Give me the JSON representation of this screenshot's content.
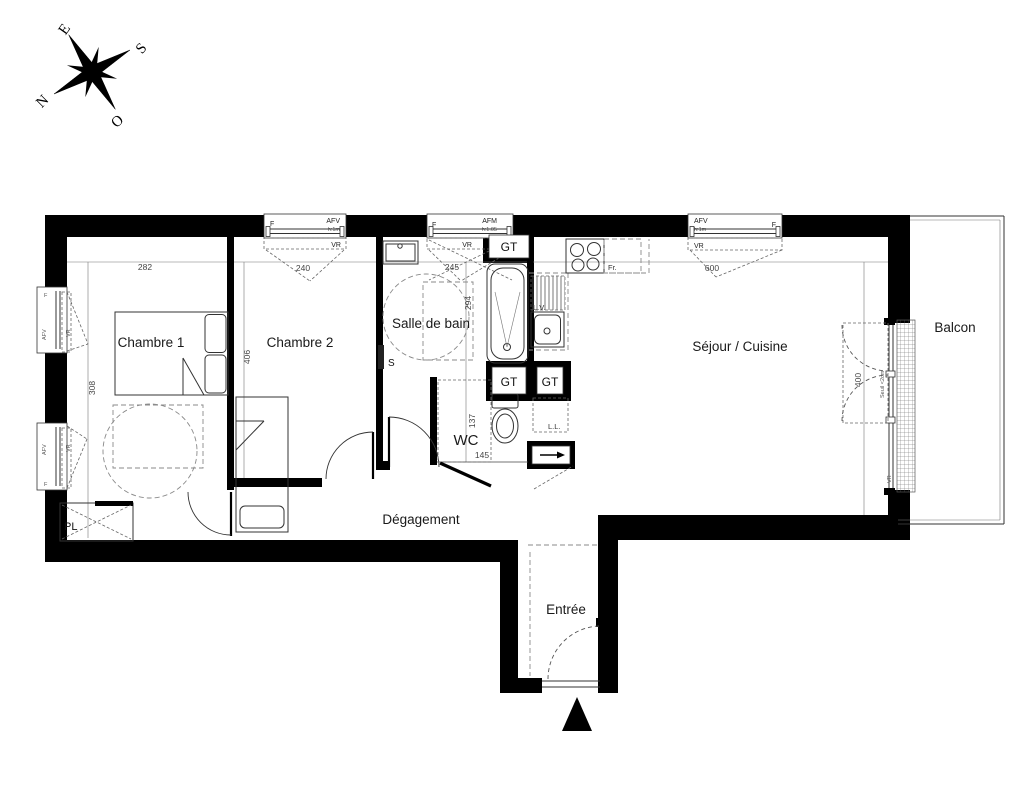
{
  "meta": {
    "type": "floor-plan",
    "style": "french-architectural"
  },
  "colors": {
    "wall": "#000000",
    "line": "#333333",
    "dash": "#8a8a8a",
    "text": "#1a1a1a",
    "dim_text": "#444444",
    "background": "#ffffff"
  },
  "compass": {
    "n": "N",
    "s": "S",
    "e": "E",
    "o": "O"
  },
  "rooms": {
    "chambre1": "Chambre 1",
    "chambre2": "Chambre 2",
    "salle_de_bain": "Salle de bain",
    "wc": "WC",
    "sejour": "Séjour / Cuisine",
    "balcon": "Balcon",
    "degagement": "Dégagement",
    "entree": "Entrée",
    "placard": "PL"
  },
  "dimensions": {
    "chambre1_width": "282",
    "chambre2_width": "240",
    "sdb_width": "245",
    "sejour_width": "600",
    "chambre1_depth": "308",
    "chambre2_depth": "406",
    "sdb_depth": "294",
    "wc_depth": "137",
    "wc_width": "145",
    "baie_width": "400"
  },
  "windows": {
    "top_chambre2": {
      "f": "F",
      "type": "AFV",
      "h": "h:1m",
      "vr": "VR"
    },
    "top_sdb": {
      "f": "F",
      "type": "AFM",
      "h": "h:1.05",
      "vr": "VR"
    },
    "top_sejour": {
      "type": "AFV",
      "h": "h:1m",
      "f": "F",
      "vr": "VR"
    },
    "left_1": {
      "f": "F",
      "type": "AFV",
      "vr": "VR",
      "h": "h:1m"
    },
    "left_2": {
      "f": "F",
      "type": "AFV",
      "vr": "VR",
      "h": "h:1m"
    },
    "baie": {
      "seuil": "Seuil <2cm",
      "vr": "VR"
    }
  },
  "equipment": {
    "gt1": "GT",
    "gt2": "GT",
    "gt3": "GT",
    "lave_linge": "L.L.",
    "lave_vaisselle": "L.V.",
    "frigo": "Fr.",
    "seche_serviette": "S"
  }
}
